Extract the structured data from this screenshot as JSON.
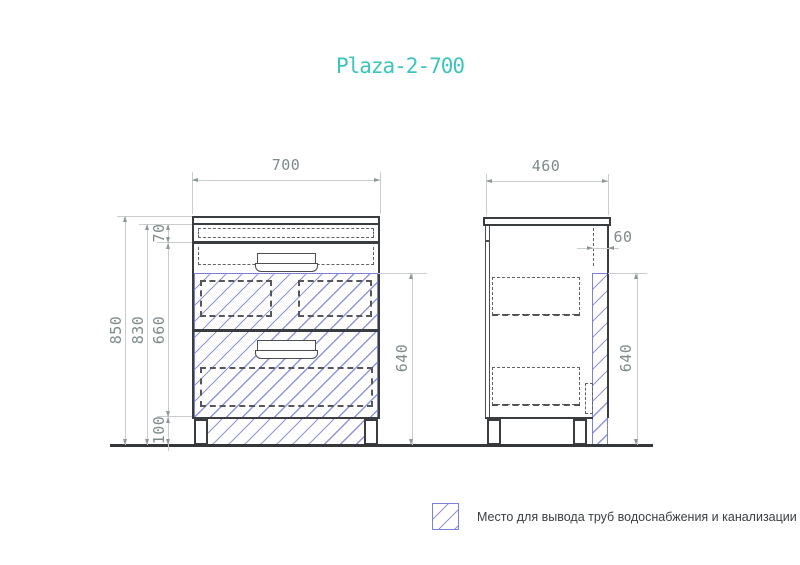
{
  "title": "Plaza-2-700",
  "dims": {
    "front_width": "700",
    "side_depth": "460",
    "total_height": "850",
    "body_height": "830",
    "drawer_section_height": "660",
    "top_section_height": "70",
    "legs_height": "100",
    "front_pipe_zone_height": "640",
    "side_pipe_zone_height": "640",
    "pipe_zone_depth": "60"
  },
  "legend": {
    "swatch_icon": "pipe-zone-hatch-swatch",
    "text": "Место для вывода труб водоснабжения и канализации"
  },
  "colors": {
    "accent_teal": "#3cc4bd",
    "hatch_blue": "#8f94de",
    "hatch_border_blue": "#7b82d6",
    "dim_text_gray": "#7e8a8a",
    "line_dark": "#3a3d40"
  }
}
